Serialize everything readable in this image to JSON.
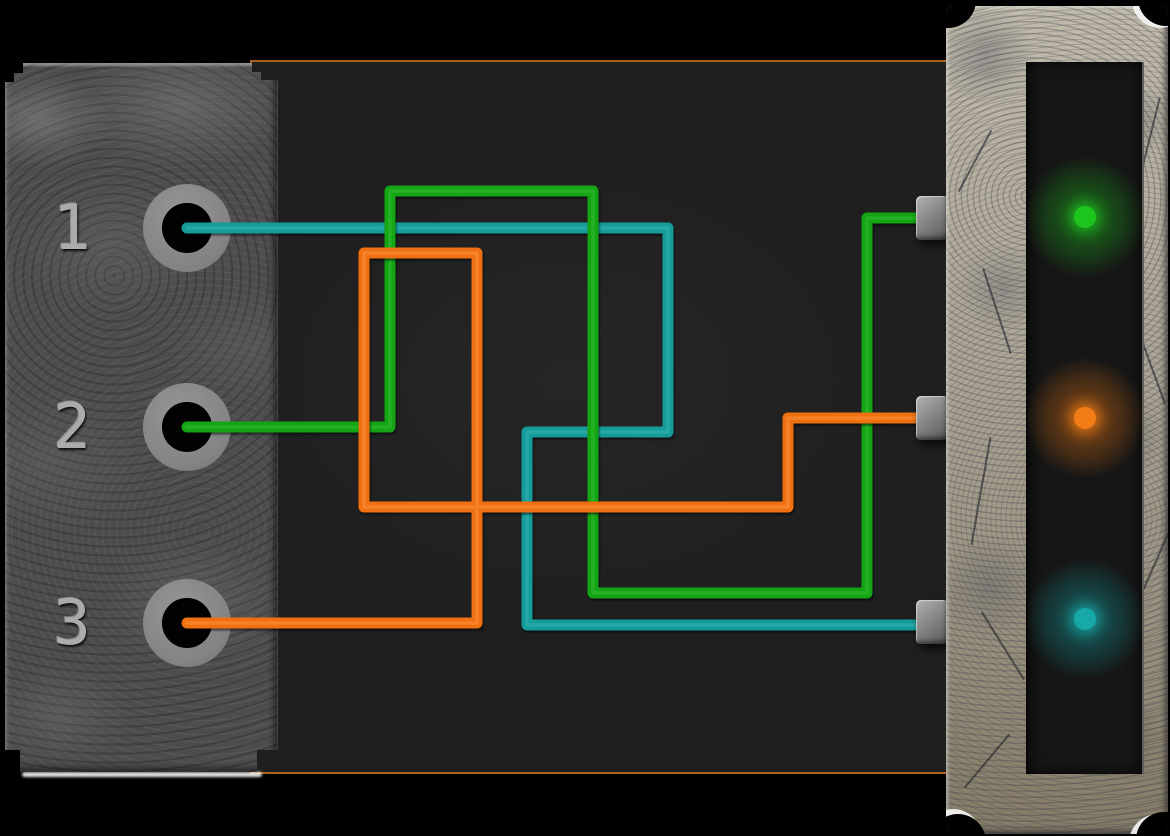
{
  "scene": {
    "name": "wire-connection-puzzle",
    "background_color": "#000000",
    "panel_color": "#1f1f1f",
    "panel_border_color": "#a9611b"
  },
  "ports": [
    {
      "id": "1",
      "label": "1",
      "x": 187,
      "y": 228
    },
    {
      "id": "2",
      "label": "2",
      "x": 187,
      "y": 427
    },
    {
      "id": "3",
      "label": "3",
      "x": 187,
      "y": 623
    }
  ],
  "wires": [
    {
      "name": "wire-teal-port-1-to-socket-3",
      "color": "#169b9b",
      "highlight": "#3fbcbc",
      "points": "187,228 668,228 668,432 527,432 527,625 940,625"
    },
    {
      "name": "wire-green-port-2-to-socket-1",
      "color": "#14a414",
      "highlight": "#3cc93c",
      "points": "187,427 390,427 390,191 593,191 593,593 867,593 867,218 940,218"
    },
    {
      "name": "wire-orange-port-3-to-socket-2",
      "color": "#ee7011",
      "highlight": "#ff9d45",
      "points": "187,623 477,623 477,253 364,253 364,507 788,507 788,418 940,418"
    }
  ],
  "sockets": [
    {
      "name": "socket-1",
      "x": 916,
      "y": 218
    },
    {
      "name": "socket-2",
      "x": 916,
      "y": 418
    },
    {
      "name": "socket-3",
      "x": 916,
      "y": 622
    }
  ],
  "lights": [
    {
      "name": "indicator-light-green",
      "color": "#1ec41e",
      "glow": "30,196,30",
      "x": 1083,
      "y": 217
    },
    {
      "name": "indicator-light-orange",
      "color": "#f27c15",
      "glow": "242,124,21",
      "x": 1083,
      "y": 418
    },
    {
      "name": "indicator-light-teal",
      "color": "#17a8a8",
      "glow": "23,168,168",
      "x": 1083,
      "y": 619
    }
  ]
}
